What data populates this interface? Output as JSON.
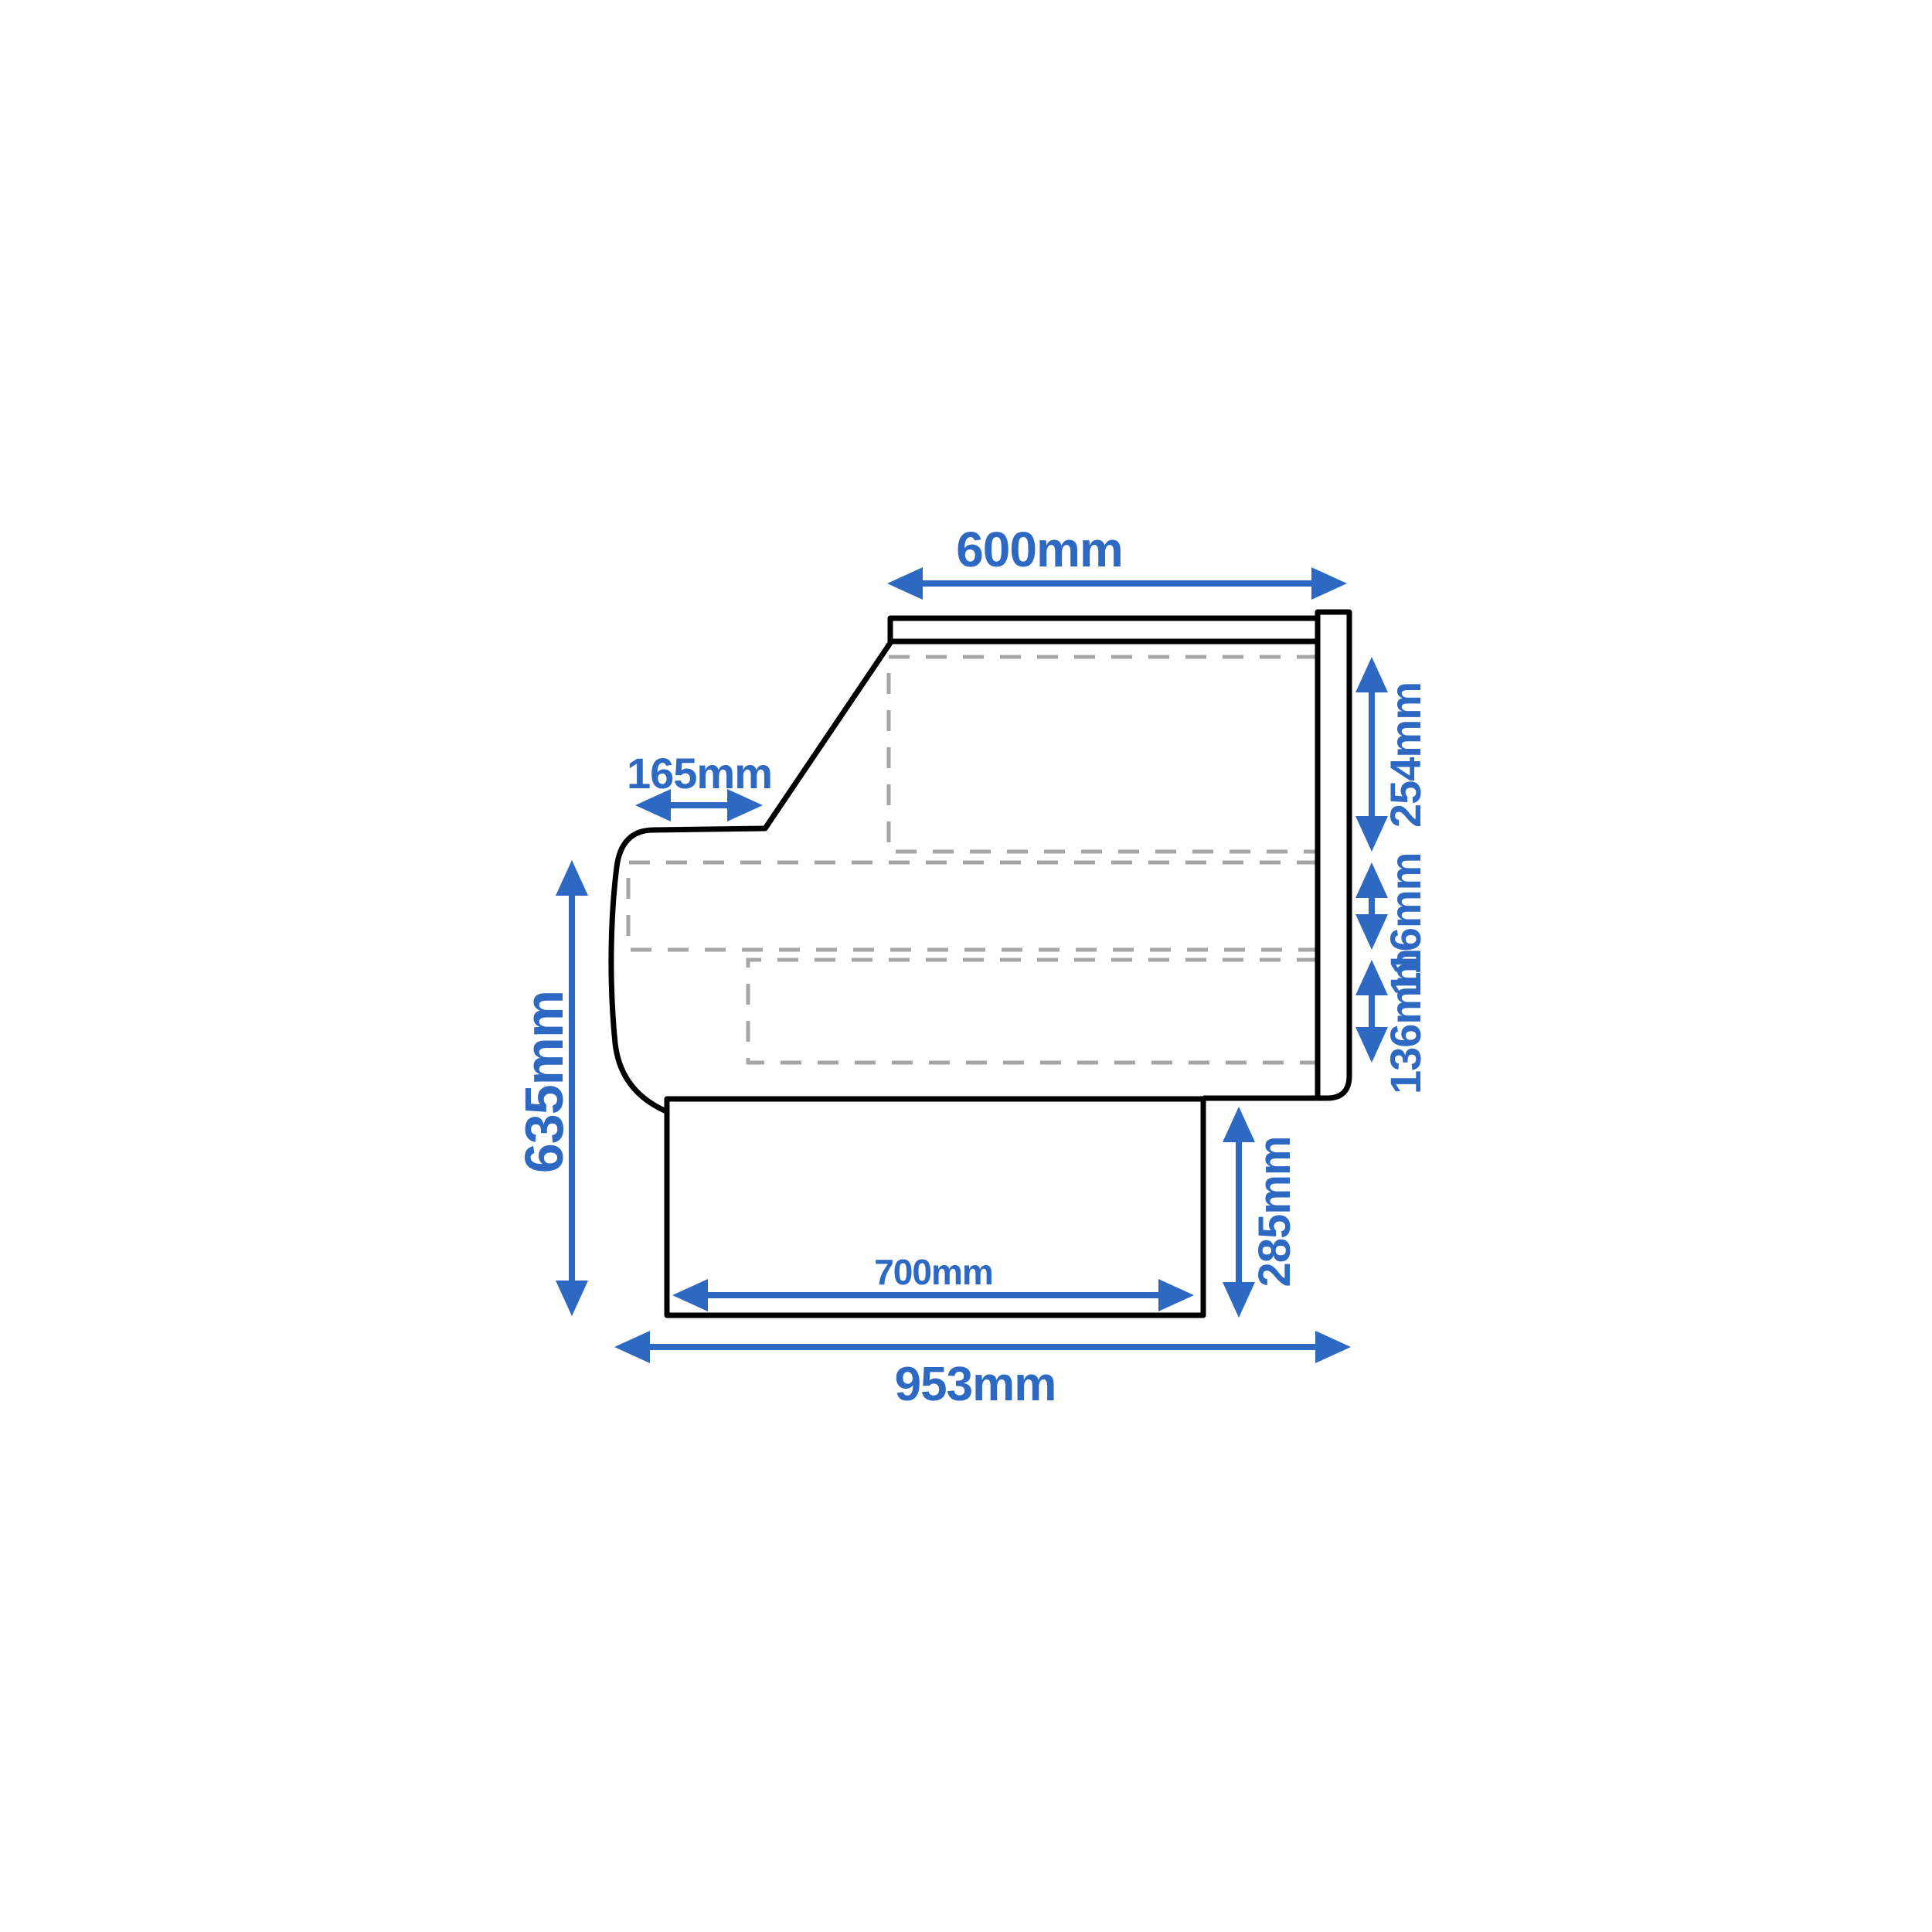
{
  "diagram": {
    "description": "Side-profile technical dimension drawing of a serve-over refrigerated display counter",
    "colors": {
      "background": "#ffffff",
      "outline": "#000000",
      "hidden_shelf_lines": "#a6a6a6",
      "dimension_accent": "#2d69c3"
    },
    "dimensions": {
      "top_depth": "600mm",
      "slope_depth": "165mm",
      "upper_shelf_height": "254mm",
      "middle_shelf_height": "116mm",
      "lower_shelf_height": "136mm",
      "front_height": "635mm",
      "base_height": "285mm",
      "base_depth": "700mm",
      "overall_depth": "953mm"
    }
  }
}
